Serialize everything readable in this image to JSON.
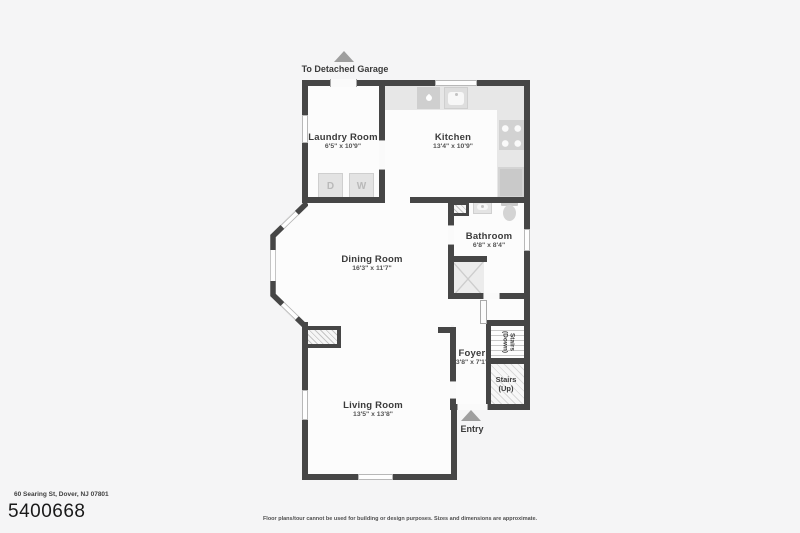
{
  "colors": {
    "wall": "#464646",
    "background": "#f5f5f6",
    "room_fill": "#fcfcfc",
    "arrow": "#9e9e9e"
  },
  "header": {
    "garage_label": "To Detached Garage"
  },
  "rooms": {
    "laundry": {
      "name": "Laundry Room",
      "dims": "6'5\" x 10'9\""
    },
    "kitchen": {
      "name": "Kitchen",
      "dims": "13'4\" x 10'9\""
    },
    "bathroom": {
      "name": "Bathroom",
      "dims": "6'8\" x 8'4\""
    },
    "dining": {
      "name": "Dining Room",
      "dims": "16'3\" x 11'7\""
    },
    "foyer": {
      "name": "Foyer",
      "dims": "3'8\" x 7'1\""
    },
    "living": {
      "name": "Living Room",
      "dims": "13'5\" x 13'8\""
    },
    "stairs_down": {
      "line1": "Stairs",
      "line2": "(Down)"
    },
    "stairs_up": {
      "line1": "Stairs",
      "line2": "(Up)"
    }
  },
  "labels": {
    "entry": "Entry"
  },
  "appliances": {
    "dryer": "D",
    "washer": "W"
  },
  "footer": {
    "address": "60 Searing St, Dover, NJ 07801",
    "mls_number": "5400668",
    "disclaimer": "Floor plans/tour cannot be used for building or design purposes. Sizes and dimensions are approximate."
  }
}
